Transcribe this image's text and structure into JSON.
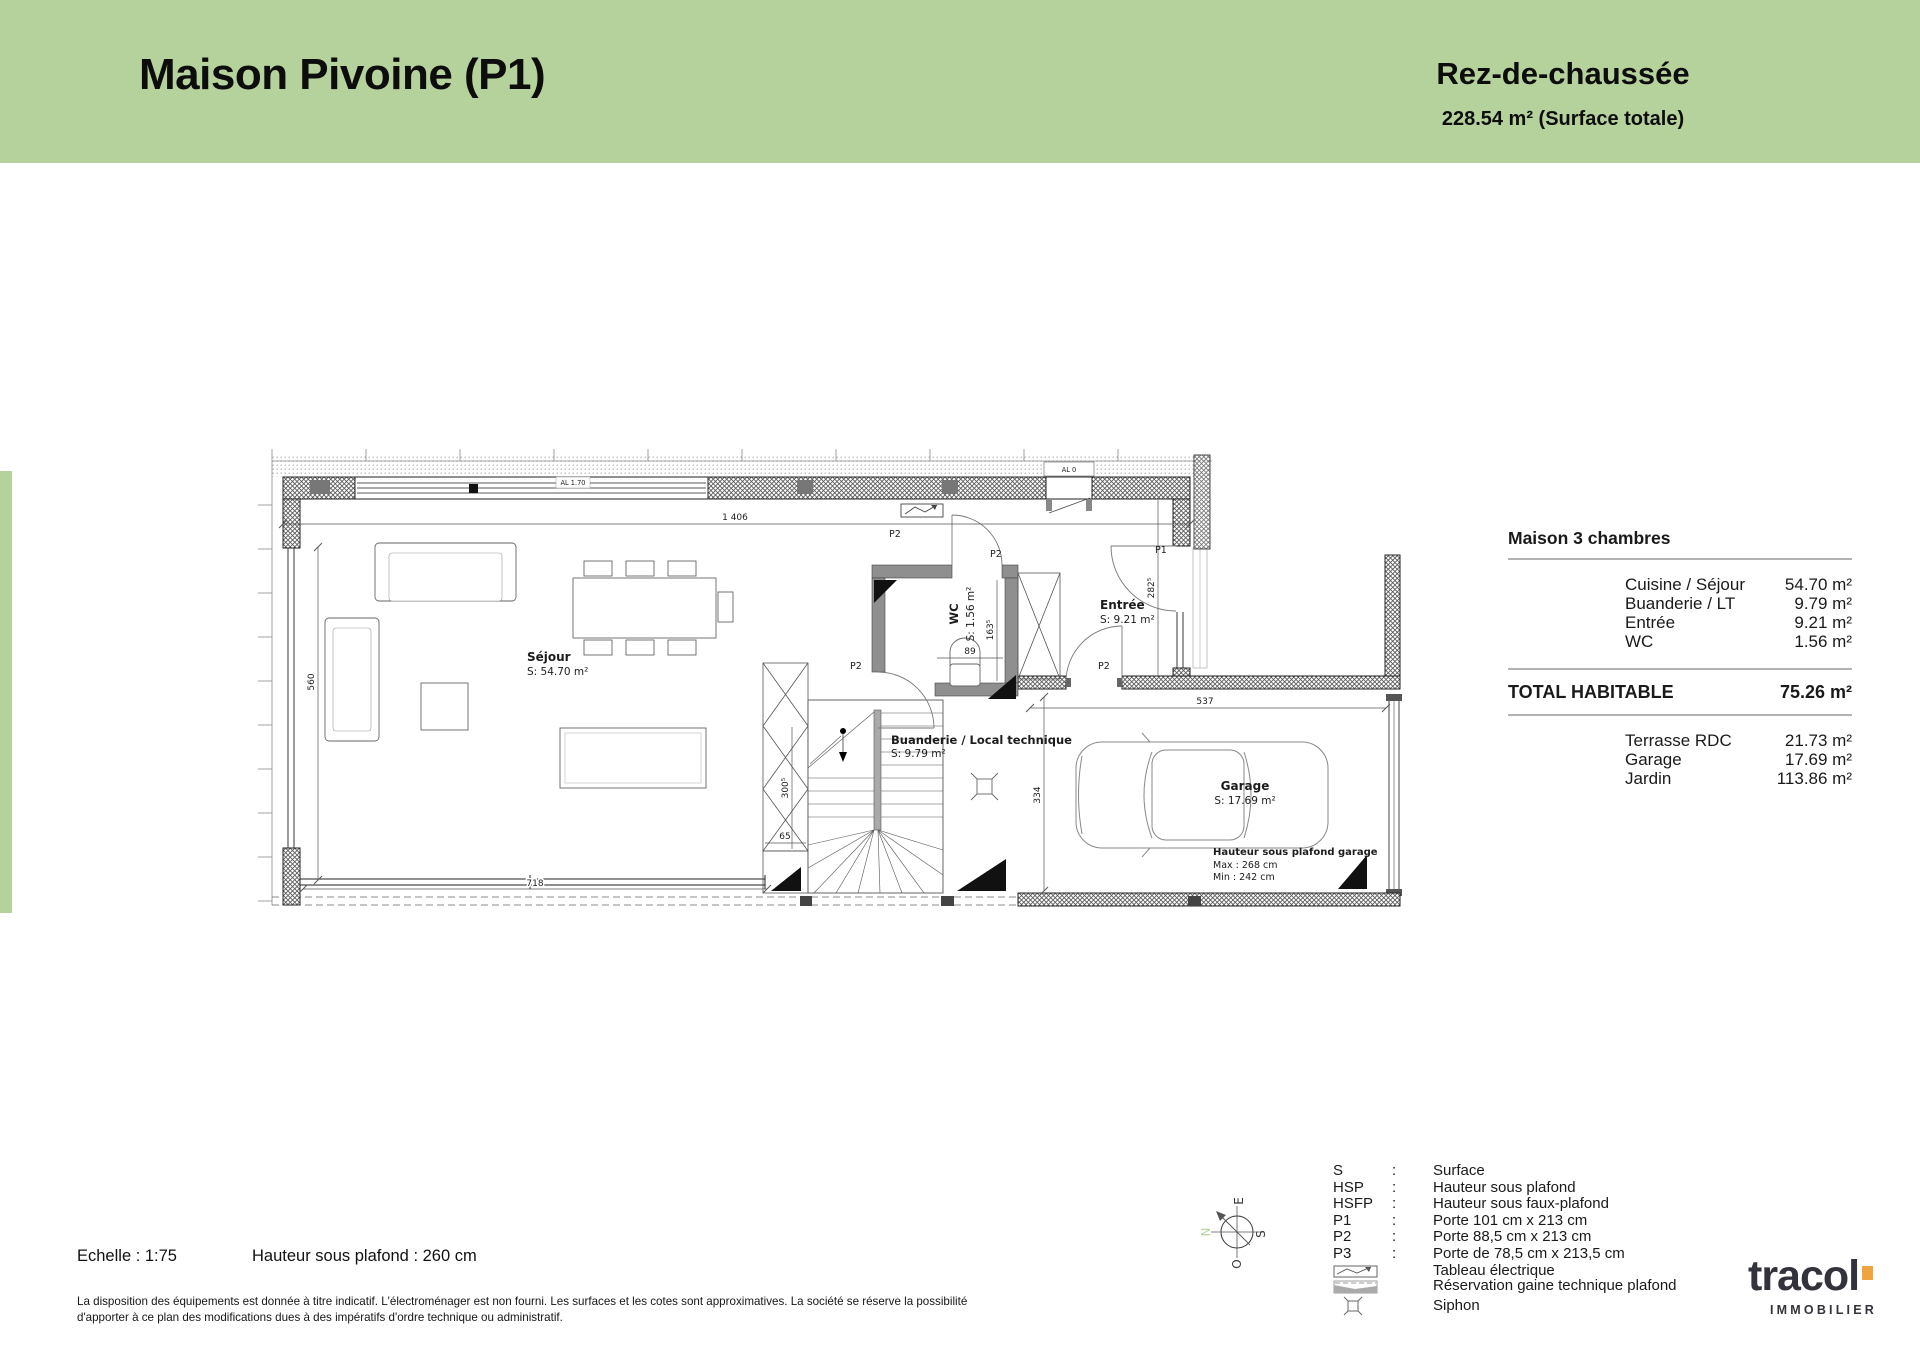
{
  "header": {
    "title": "Maison Pivoine (P1)",
    "floor": "Rez-de-chaussée",
    "total_surface": "228.54 m² (Surface totale)",
    "band_color": "#b6d29c"
  },
  "surface_table": {
    "title": "Maison 3 chambres",
    "rows": [
      {
        "label": "Cuisine / Séjour",
        "value": "54.70 m²"
      },
      {
        "label": "Buanderie / LT",
        "value": "9.79 m²"
      },
      {
        "label": "Entrée",
        "value": "9.21 m²"
      },
      {
        "label": "WC",
        "value": "1.56 m²"
      }
    ],
    "total_label": "TOTAL HABITABLE",
    "total_value": "75.26 m²",
    "extra_rows": [
      {
        "label": "Terrasse RDC",
        "value": "21.73 m²"
      },
      {
        "label": "Garage",
        "value": "17.69 m²"
      },
      {
        "label": "Jardin",
        "value": "113.86 m²"
      }
    ]
  },
  "plan": {
    "rooms": [
      {
        "name": "Séjour",
        "area": "S: 54.70 m²"
      },
      {
        "name": "WC",
        "area": "S: 1.56 m²"
      },
      {
        "name": "Entrée",
        "area": "S: 9.21 m²"
      },
      {
        "name": "Buanderie / Local technique",
        "area": "S: 9.79 m²"
      },
      {
        "name": "Garage",
        "area": "S: 17.69 m²"
      }
    ],
    "garage_ceiling": {
      "title": "Hauteur sous plafond garage",
      "max": "Max : 268 cm",
      "min": "Min : 242 cm"
    },
    "window_labels": [
      "AL 1.70",
      "AL 0"
    ],
    "door_labels": [
      "P1",
      "P2",
      "P2",
      "P2",
      "P2"
    ],
    "dimensions": [
      "1 406",
      "560",
      "282⁵",
      "163⁵",
      "89",
      "300⁵",
      "65",
      "537",
      "334",
      "718"
    ]
  },
  "legend": {
    "colon": ":",
    "items": [
      {
        "abbr": "S",
        "def": "Surface"
      },
      {
        "abbr": "HSP",
        "def": "Hauteur sous plafond"
      },
      {
        "abbr": "HSFP",
        "def": "Hauteur sous faux-plafond"
      },
      {
        "abbr": "P1",
        "def": "Porte 101 cm x 213 cm"
      },
      {
        "abbr": "P2",
        "def": "Porte 88,5 cm x 213 cm"
      },
      {
        "abbr": "P3",
        "def": "Porte de 78,5 cm x 213,5 cm"
      }
    ],
    "symbol_items": [
      {
        "symbol": "tableau-electrique",
        "def": "Tableau électrique"
      },
      {
        "symbol": "reservation-gaine",
        "def": "Réservation gaine technique plafond"
      },
      {
        "symbol": "siphon",
        "def": "Siphon"
      }
    ],
    "compass": {
      "n": "N",
      "e": "E",
      "s": "S",
      "o": "O"
    }
  },
  "footer": {
    "scale": "Echelle : 1:75",
    "ceiling_height": "Hauteur sous plafond : 260 cm",
    "disclaimer_line1": "La disposition des équipements est donnée à titre indicatif. L'électroménager est non fourni. Les surfaces et les cotes sont approximatives. La société se réserve la possibilité",
    "disclaimer_line2": "d'apporter à ce plan des modifications dues à des impératifs d'ordre technique ou administratif."
  },
  "logo": {
    "name": "tracol",
    "sub": "IMMOBILIER",
    "accent_color": "#f0a43f"
  }
}
